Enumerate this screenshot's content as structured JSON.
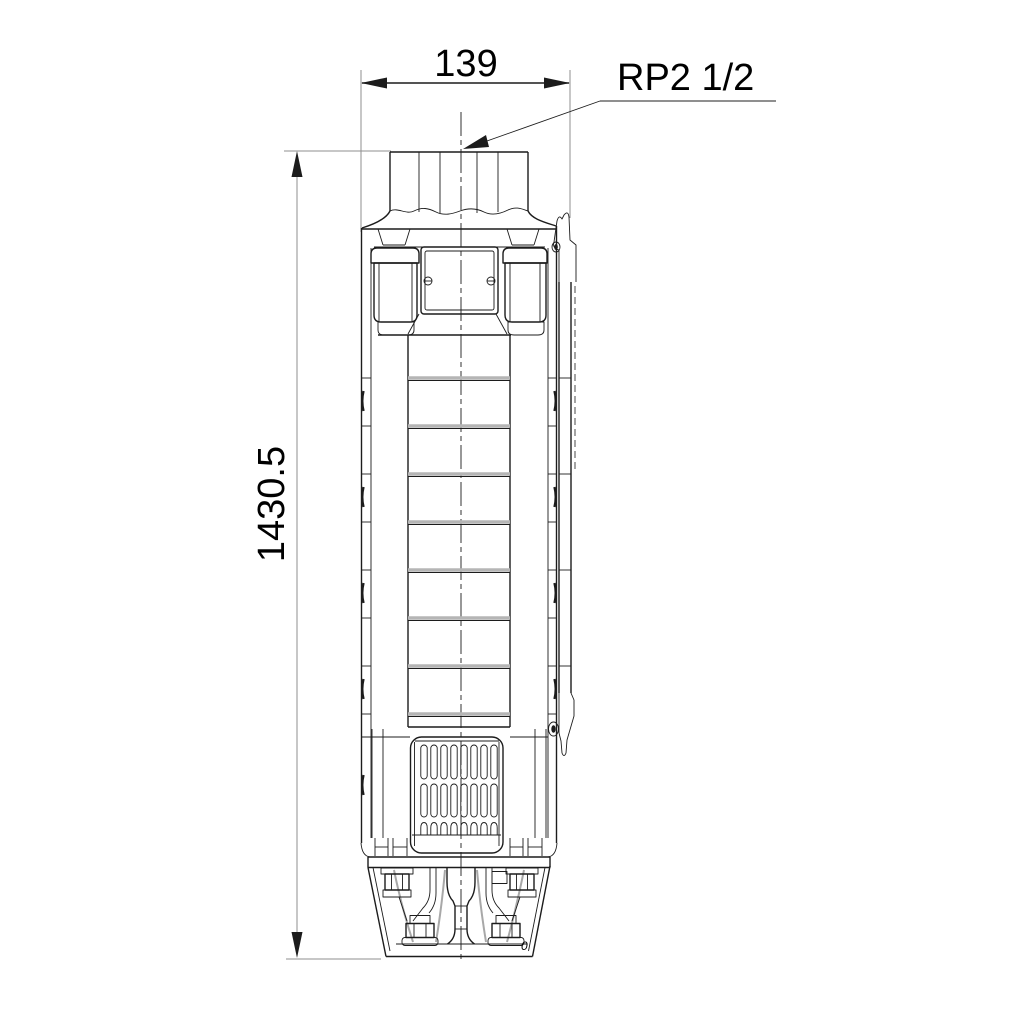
{
  "drawing": {
    "dimensions": {
      "width": "139",
      "height": "1430.5"
    },
    "connection_label": "RP2 1/2",
    "base_mark": "0"
  },
  "colors": {
    "line": "#1c1c1c",
    "dimension_gray": "#8f8f8f",
    "shade_gray": "#b5b5b5",
    "background": "#ffffff"
  }
}
